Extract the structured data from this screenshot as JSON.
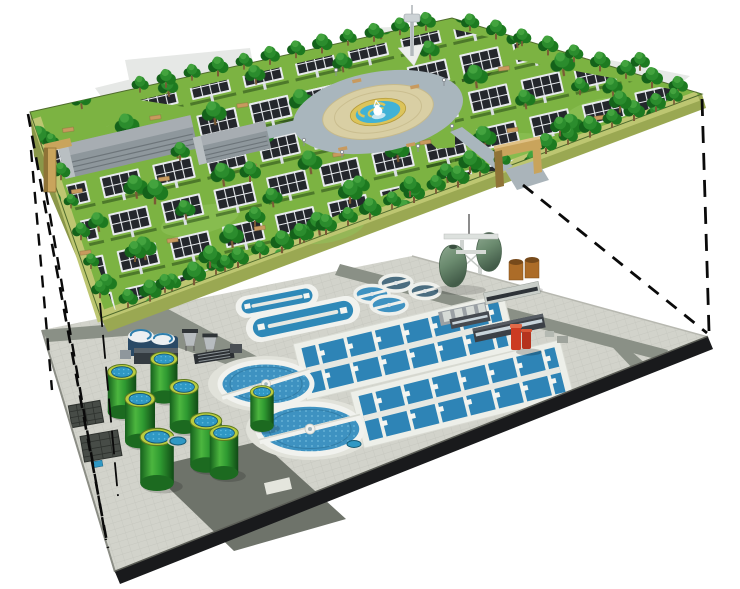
{
  "palette": {
    "bg": "#ffffff",
    "line": "#0a0a0a",
    "grass": "#7cb342",
    "grassLight": "#92c55c",
    "rim": "#bdc671",
    "platformSideL": "#8a9749",
    "platformSideR": "#9aa852",
    "treeDark": "#14621a",
    "tree": "#1d7a20",
    "treeMid": "#2b8c2d",
    "treeLight": "#43a33e",
    "trunk": "#7a5a35",
    "panel": "#24272c",
    "panelGrid": "#e8ebee",
    "plazaRoad": "#a9b6bd",
    "plazaPave": "#d9cfa4",
    "plazaYellow": "#dcc45a",
    "poolBlue": "#41b2d6",
    "towerGray": "#c2c8cc",
    "gateTan": "#c9a45c",
    "gateTanDark": "#8f7337",
    "bldgGray": "#8e979c",
    "bldgRoof": "#a7adb2",
    "ghost": "#e0e3e0",
    "pavement": "#d2d3cb",
    "tileLine": "#b9bab2",
    "road": "#8a9086",
    "apron": "#6e736a",
    "edgeBlack": "#191a1c",
    "white": "#f1f2ee",
    "waterBasin": "#2e84b6",
    "waterDitch": "#2f89b8",
    "waterTop": "#2f98c4",
    "waterDark": "#4a6d80",
    "clarifierBlue": "#3e92c1",
    "cylGreenDark": "#15601c",
    "cylGreen": "#2f9a31",
    "cylGreenLite": "#4cb63f",
    "cylRim": "#b9cc3f",
    "navy": "#2a4a66",
    "eggSage": "#6a8a6e",
    "eggSageLight": "#8fa991",
    "eggSageDark": "#435c49",
    "steel": "#cfd3d0",
    "darkBldg": "#3b4046",
    "windowLite": "#c8d4da",
    "red": "#cc3b22",
    "brown": "#ac6c28"
  },
  "scene": {
    "upper_level": "solar-park-deck",
    "lower_level": "wastewater-treatment-plant",
    "connectors": "projection-dashed-lines",
    "upper_parts": [
      "solar-panel-rows",
      "trees",
      "central-fountain-plaza",
      "observation-tower",
      "gatehouses",
      "park-buildings"
    ],
    "lower_parts": [
      "oxidation-ditches",
      "primary-settling-tanks",
      "aeration-basins",
      "secondary-clarifiers",
      "digester-cylinders",
      "egg-digesters",
      "storage-tanks",
      "plant-buildings",
      "screening-units",
      "roads"
    ]
  }
}
